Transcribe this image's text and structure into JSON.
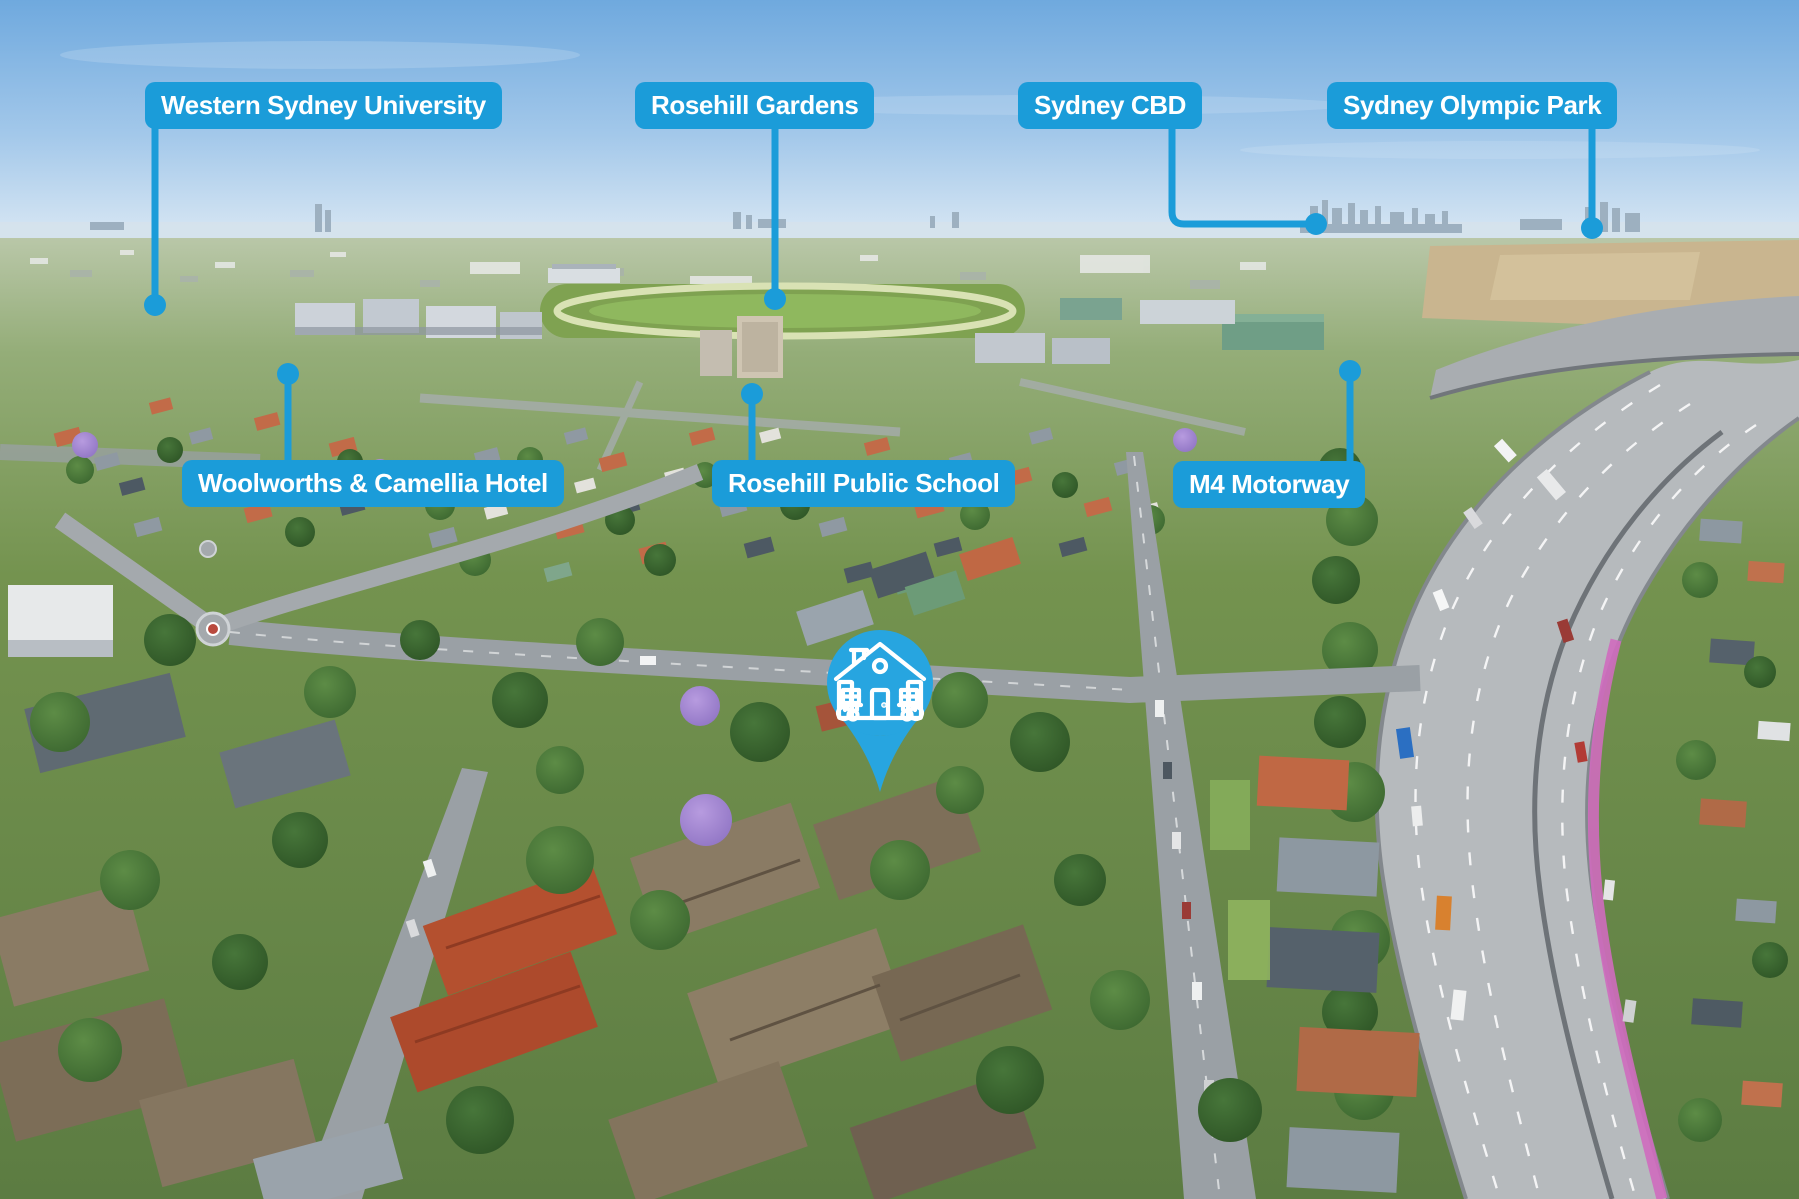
{
  "annotations": {
    "accent_color": "#1b9cd9",
    "pin_color": "#27a5e0",
    "labels": [
      {
        "id": "western-sydney-university",
        "text": "Western Sydney University"
      },
      {
        "id": "rosehill-gardens",
        "text": "Rosehill Gardens"
      },
      {
        "id": "sydney-cbd",
        "text": "Sydney CBD"
      },
      {
        "id": "sydney-olympic-park",
        "text": "Sydney Olympic Park"
      },
      {
        "id": "woolworths-camellia-hotel",
        "text": "Woolworths & Camellia Hotel"
      },
      {
        "id": "rosehill-public-school",
        "text": "Rosehill Public School"
      },
      {
        "id": "m4-motorway",
        "text": "M4 Motorway"
      }
    ],
    "pin": {
      "icon": "house-icon"
    }
  }
}
